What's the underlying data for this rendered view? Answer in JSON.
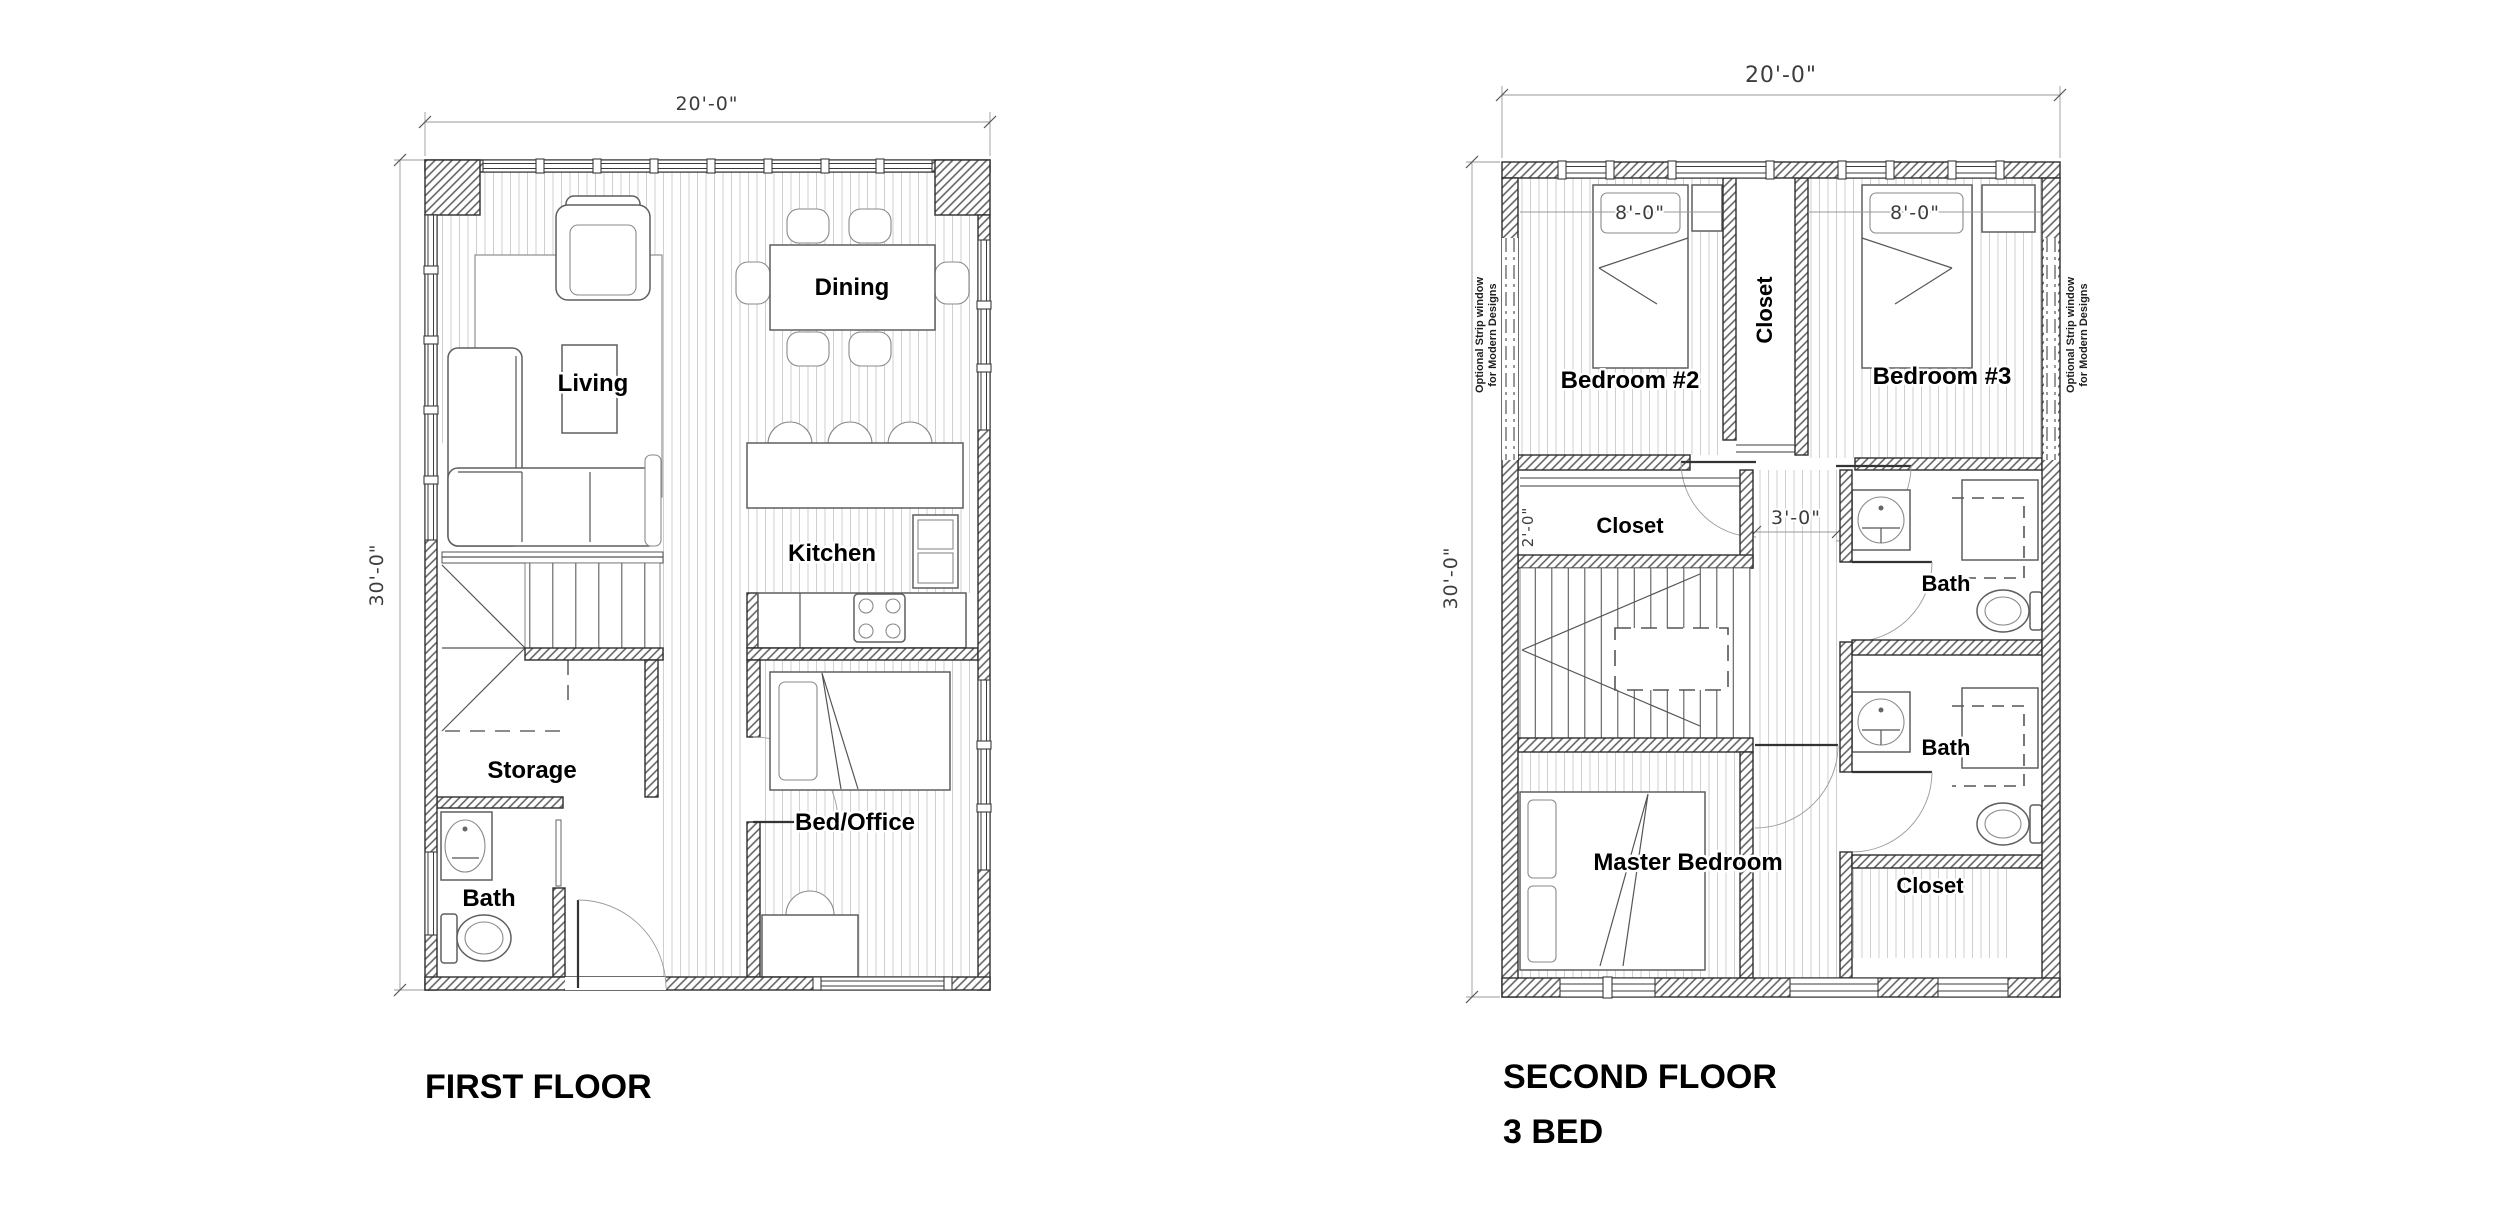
{
  "first_floor": {
    "title": "FIRST FLOOR",
    "dims": {
      "width": "20'-0\"",
      "height": "30'-0\""
    },
    "rooms": {
      "living": "Living",
      "dining": "Dining",
      "kitchen": "Kitchen",
      "storage": "Storage",
      "bath": "Bath",
      "bed_office": "Bed/Office"
    }
  },
  "second_floor": {
    "title": "SECOND FLOOR",
    "subtitle": "3 BED",
    "dims": {
      "width": "20'-0\"",
      "height": "30'-0\"",
      "bed2": "8'-0\"",
      "bed3": "8'-0\"",
      "closet_left": "2'-0\"",
      "hall": "3'-0\""
    },
    "rooms": {
      "bedroom2": "Bedroom #2",
      "bedroom3": "Bedroom #3",
      "closet_top": "Closet",
      "closet_left": "Closet",
      "closet_bottom": "Closet",
      "bath_upper": "Bath",
      "bath_lower": "Bath",
      "master": "Master Bedroom"
    },
    "notes": {
      "strip_window_line1": "Optional Strip window",
      "strip_window_line2": "for Modern Designs"
    }
  }
}
